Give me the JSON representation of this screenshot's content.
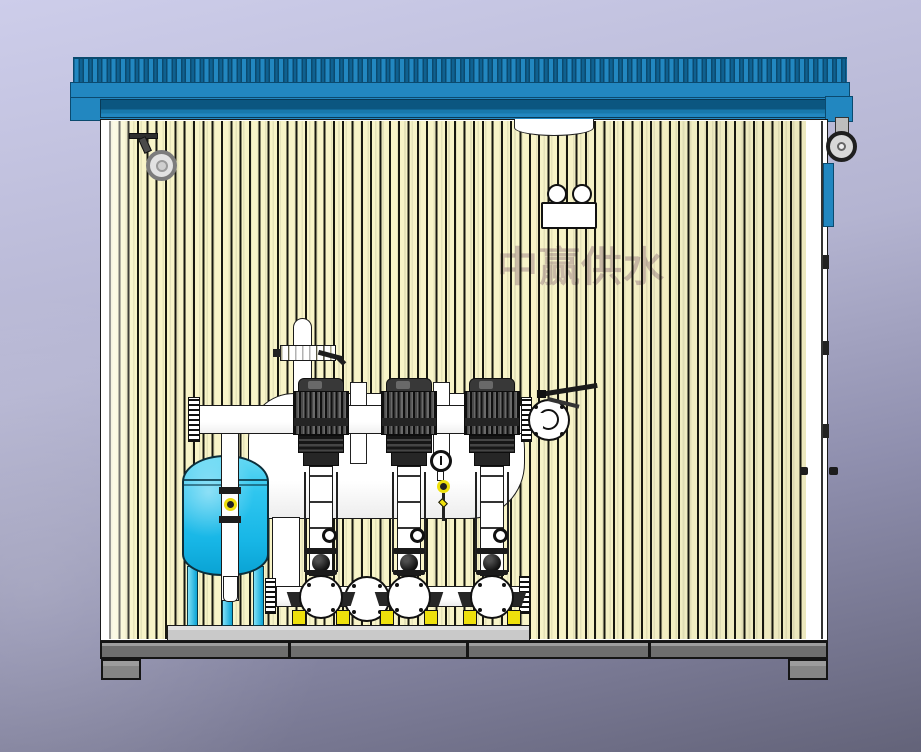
{
  "watermark": {
    "text": "中赢供水"
  },
  "equipment_counts": {
    "pumps": 3,
    "pressure_tanks": 1
  },
  "colors": {
    "bg_top": "#cdcdea",
    "bg_mid": "#b4b4d1",
    "bg_bottom": "#636379",
    "roof": "#2287c0",
    "roof_dark": "#0b4a6f",
    "soffit": "#0c5d8a",
    "wall": "#f8f4c8",
    "stripe": "#181810",
    "outline": "#1a1a1a",
    "white": "#ffffff",
    "tank": "#2fc6ef",
    "tank_deep": "#0aa3d4",
    "tank_hi": "#7fe0f7",
    "motor": "#2a2a2a",
    "skid": "#c9c9c9",
    "frame": "#6e6e6e",
    "foot": "#858585",
    "pad": "#eee00c",
    "watermark_color": "#a58c8c"
  }
}
